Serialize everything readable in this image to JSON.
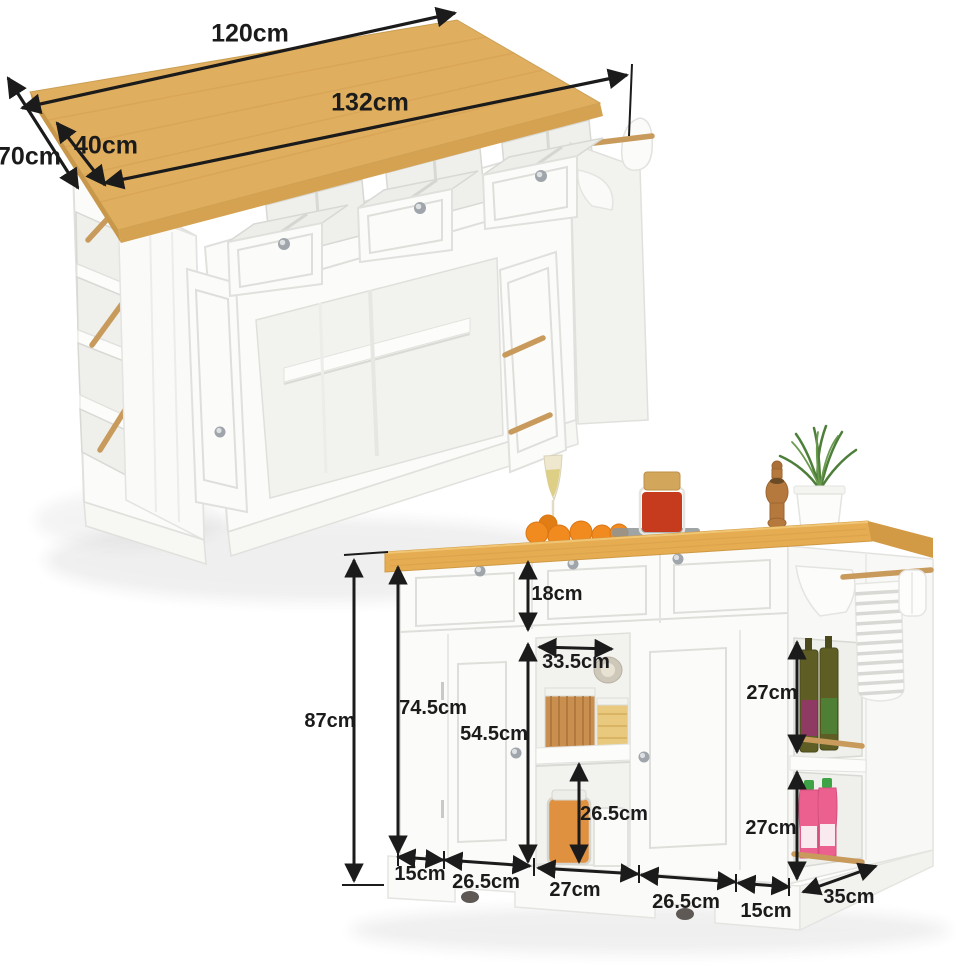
{
  "image": {
    "kind": "product-dimension-diagram",
    "product": "kitchen island cart with wood top",
    "background": "#ffffff",
    "views": [
      "perspective-open-storage",
      "front-dimensioned"
    ]
  },
  "colors": {
    "ink": "#1b1b1b",
    "wood": "#e0ae5f",
    "wood_front": "#d5a251",
    "wood_edge": "#c89749",
    "cabinet": "#fbfbf9",
    "rail_wood": "#c89b5c",
    "orange_fruit": "#f18a1f",
    "spice_red": "#c63a1d",
    "sauce_pink": "#ec6090",
    "cap_green": "#3da344",
    "olive_bottle": "#5e5e24",
    "plant_green": "#4e7f3a"
  },
  "top_view": {
    "dims": {
      "top_width": "120cm",
      "total_width": "132cm",
      "overhang_depth": "40cm",
      "top_depth": "70cm"
    }
  },
  "front_view": {
    "dims": {
      "drawer_height": "18cm",
      "opening_width": "33.5cm",
      "cabinet_inner_height": "54.5cm",
      "body_height": "74.5cm",
      "total_height": "87cm",
      "lower_opening_height": "26.5cm",
      "side_shelf_top": "27cm",
      "side_shelf_bottom": "27cm",
      "base_left_stile": "15cm",
      "base_left_door": "26.5cm",
      "base_middle": "27cm",
      "base_right_door": "26.5cm",
      "base_right_stile": "15cm",
      "side_depth": "35cm"
    }
  },
  "props_on_top": [
    "champagne-glass",
    "oranges",
    "spice-jar",
    "pepper-grinder",
    "potted-rosemary"
  ],
  "props_in_storage": [
    "pasta-containers",
    "snack-jars",
    "glass-jars",
    "milk-jug",
    "oil-bottles",
    "sauce-bottles",
    "towel",
    "paper-towel-roll"
  ]
}
